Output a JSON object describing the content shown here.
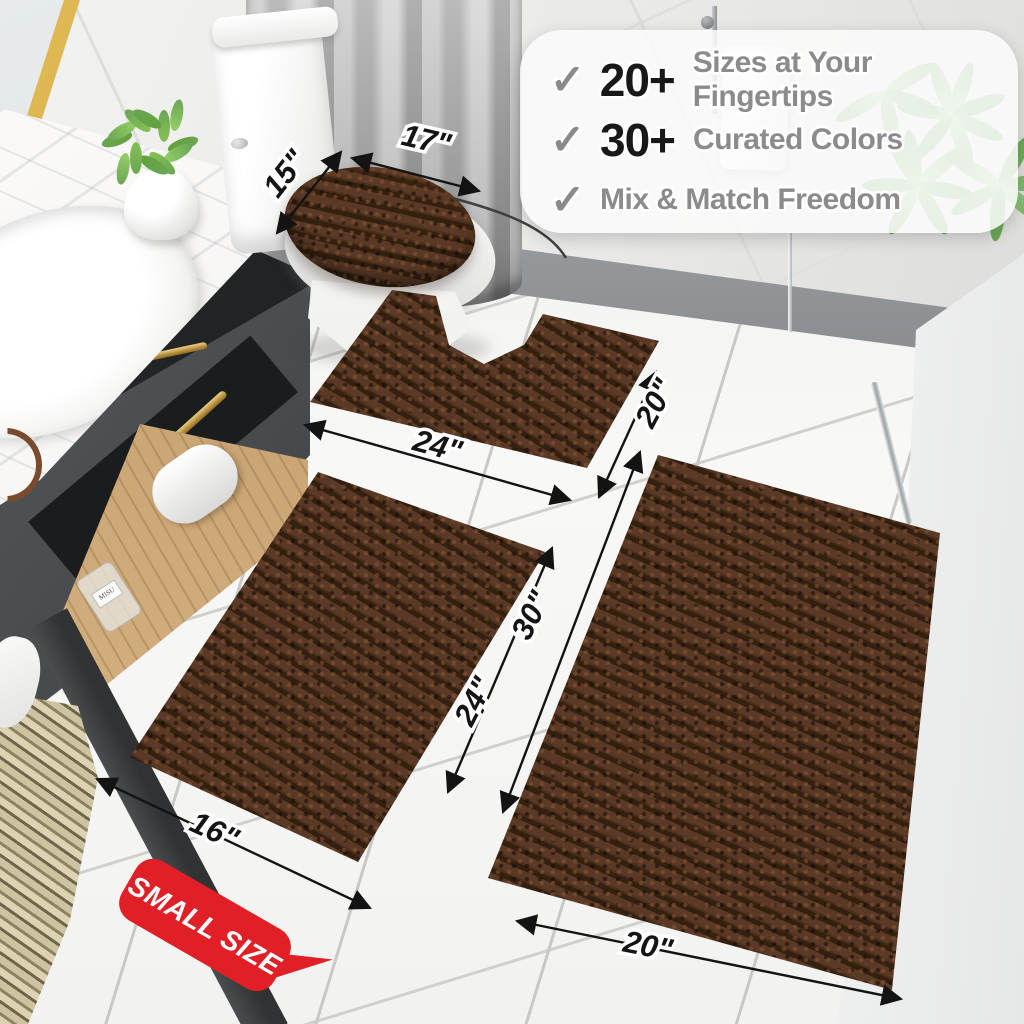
{
  "callout": {
    "check_icon": "✓",
    "items": [
      {
        "stat": "20+",
        "label": "Sizes at Your Fingertips"
      },
      {
        "stat": "30+",
        "label": "Curated Colors"
      },
      {
        "stat": "",
        "label": "Mix & Match Freedom"
      }
    ]
  },
  "dims": {
    "items": [
      {
        "part": "lid-cover",
        "edge": "height",
        "value": "15\""
      },
      {
        "part": "lid-cover",
        "edge": "width",
        "value": "17\""
      },
      {
        "part": "contour-rug",
        "edge": "width",
        "value": "24\""
      },
      {
        "part": "contour-rug",
        "edge": "depth",
        "value": "20\""
      },
      {
        "part": "small-rug",
        "edge": "width",
        "value": "16\""
      },
      {
        "part": "small-rug",
        "edge": "length",
        "value": "24\""
      },
      {
        "part": "large-rug",
        "edge": "length",
        "value": "30\""
      },
      {
        "part": "large-rug",
        "edge": "width",
        "value": "20\""
      }
    ]
  },
  "badge": {
    "label": "SMALL SIZE"
  },
  "scene": {
    "bottle_label": "MISU"
  },
  "colors": {
    "rug_brown": "#46291a",
    "badge_red": "#e01f26",
    "check_gray": "#8a8a8a",
    "gold_accent": "#c9a24a"
  }
}
